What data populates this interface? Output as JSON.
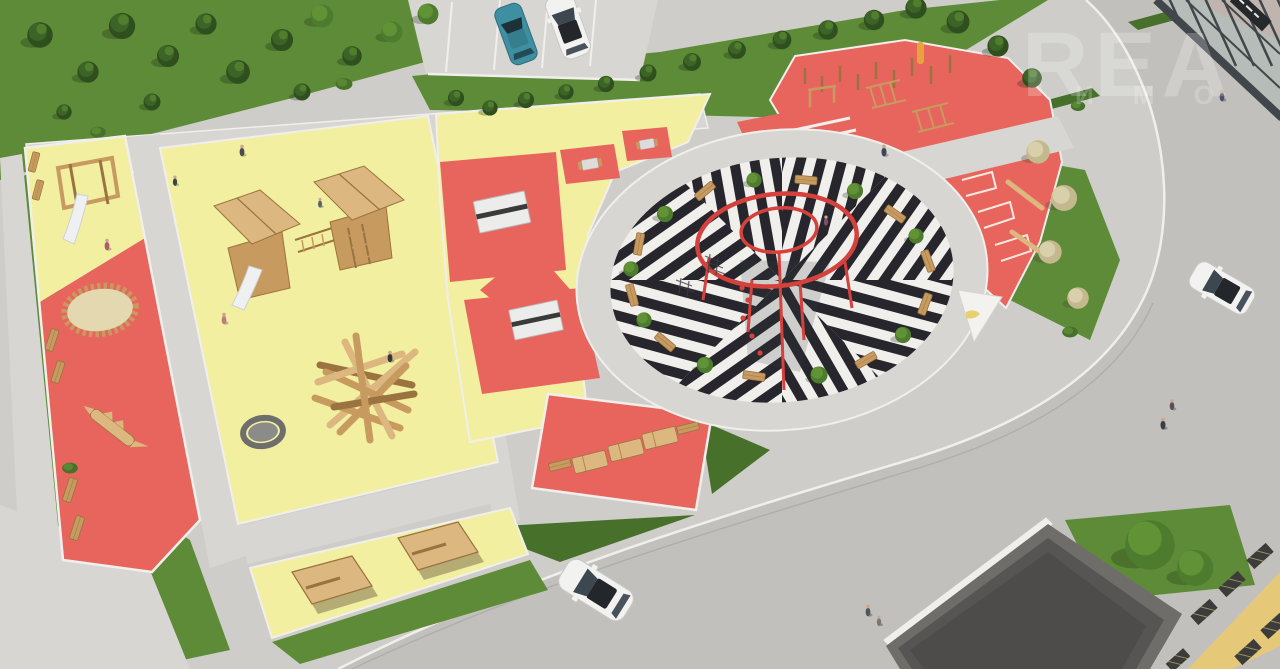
{
  "watermark": {
    "line1": "REA",
    "line2": "И М О"
  },
  "colors": {
    "pavement": "#cecdc9",
    "road": "#c2c0bc",
    "path": "#d8d6d2",
    "curb": "#f1efeb",
    "grass": "#5d8b37",
    "grassDark": "#47702b",
    "conifer": "#2f4f1f",
    "coniferMid": "#3c6427",
    "coniferLight": "#55842e",
    "broadleaf": "#4e7c2e",
    "broadleafLight": "#619336",
    "flowering": "#c3b88e",
    "floweringLight": "#d8cfab",
    "yellow": "#f2efa0",
    "red": "#e8655e",
    "ringRed": "#d5413c",
    "plazaBlack": "#26262c",
    "plazaWhite": "#f0efec",
    "wood": "#c79a5f",
    "woodDark": "#9a7340",
    "woodLight": "#dcb77f",
    "slide": "#eef0f1",
    "sand": "#e3d8b0",
    "trampoline": "#8b8b89",
    "carTeal": "#3e8fa1",
    "carWhite": "#f2f2f0",
    "glass": "#b6bcb8",
    "glassReflect": "#c8afa6",
    "frameDark": "#41464a",
    "roofRim": "#6e6d6a",
    "roofDark": "#565553",
    "lattice": "#3c3c3a",
    "walkYellow": "#e5c979"
  }
}
